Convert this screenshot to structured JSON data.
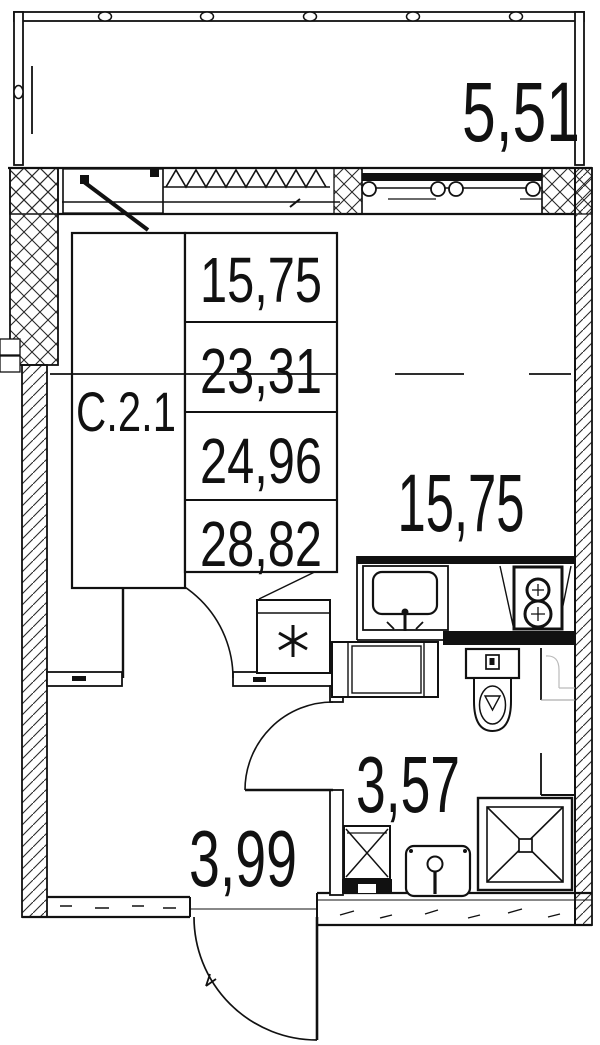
{
  "document": {
    "type": "apartment floor plan",
    "unit_label": "С.2.1"
  },
  "labels": {
    "balcony_area": "5,51",
    "room_area": "15,75",
    "bathroom_area": "3,57",
    "hallway_area": "3,99"
  },
  "area_table": {
    "rows": [
      {
        "value": "15,75",
        "struck": false
      },
      {
        "value": "23,31",
        "struck": true
      },
      {
        "value": "24,96",
        "struck": false
      },
      {
        "value": "28,82",
        "struck": false
      }
    ]
  },
  "colors": {
    "ink": "#111111",
    "paper": "#ffffff",
    "hatch": "#2a2a2a",
    "faint": "#bbbbbb"
  }
}
